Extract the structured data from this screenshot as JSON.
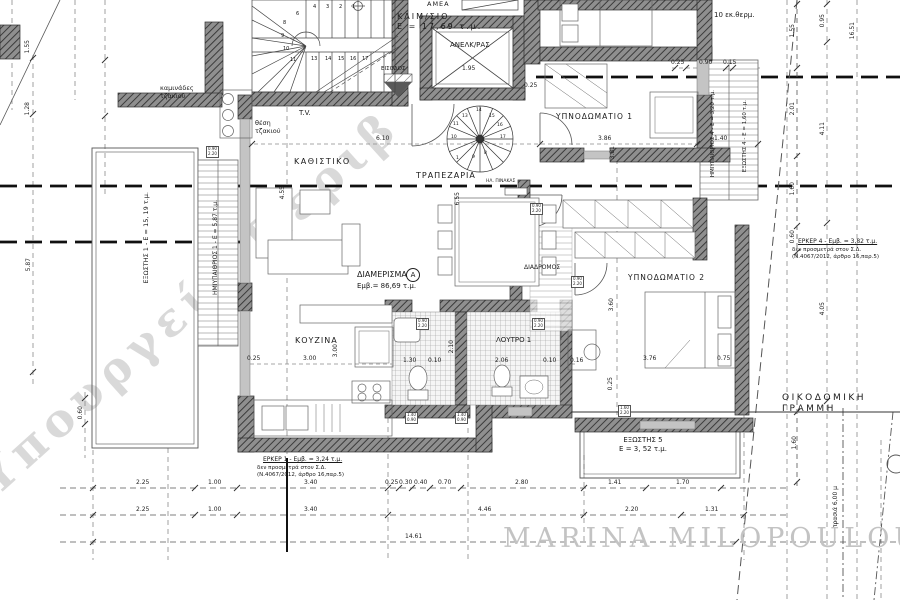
{
  "watermarks": {
    "diagonal": "Υπουργείο Περιβ",
    "signature": "MARINA MILOPOULOU"
  },
  "labels": {
    "living": "ΚΑΘΙΣΤΙΚΟ",
    "tv": "T.V.",
    "fireplace": "θέση\nτζακιού",
    "chimneys": "καμινάδες\nτζακιού",
    "staircase": "ΚΛΙΜ/ΣΙΟ\nΕ = 17,69 τ.μ.",
    "elevator": "ΑΝΕΛΚ/ΡΑΣ",
    "amea": "ΑΜΕΑ",
    "entrance": "ΕΙΣΟΔΟΣ",
    "dining": "ΤΡΑΠΕΖΑΡΙΑ",
    "bedroom1": "ΥΠΝΟΔΩΜΑΤΙΟ 1",
    "insulation": "10 εκ.θερμ.",
    "apartment": "ΔΙΑΜΕΡΙΣΜΑ",
    "apartment_badge": "A",
    "apartment_area": "Εμβ.= 86,69 τ.μ.",
    "kitchen": "ΚΟΥΖΙΝΑ",
    "bathroom": "ΛΟΥΤΡΟ 1",
    "corridor": "ΔΙΑΔΡΟΜΟΣ",
    "bedroom2": "ΥΠΝΟΔΩΜΑΤΙΟ 2",
    "balcony5": "ΕΞΩΣΤΗΣ 5\nΕ = 3, 52 τ.μ.",
    "building_line": "ΟΙΚΟΔΟΜΙΚΗ ΓΡΑΜΜΗ",
    "panel": "ΗΛ. ΠΙΝΑΚΑΣ",
    "balcony1": "ΕΞΩΣΤΗΣ 1 - Ε = 15, 19 τ.μ.",
    "semi1": "ΗΜΙΥΠΑΙΘΡΙΟΣ 1 - Ε = 5,87 τ.μ.",
    "semi4": "ΗΜΙΥΠΑΙΘΡΙΟΣ 4 - Ε = 3,20 τ.μ.",
    "balcony4": "ΕΞΩΣΤΗΣ 4 - Ε = 1,60 τ.μ.",
    "grass": "πρασιά 6,00 μ"
  },
  "notes": {
    "erker1_title": "ΕΡΚΕΡ 1 - Εμβ. = 3,24 τ.μ.",
    "erker1_body": "δεν προσμετρά στον Σ.Δ.\n(Ν.4067/2012, άρθρο 16,παρ.5)",
    "erker4_title": "ΕΡΚΕΡ 4 - Εμβ. = 3,82 τ.μ.",
    "erker4_body": "δεν προσμετρά στον Σ.Δ.\n(Ν.4067/2012, άρθρο 16,παρ.5)"
  },
  "dims": {
    "bottom1": [
      "2.25",
      "1.00",
      "3.40",
      "0.25",
      "0.30",
      "0.40",
      "0.70",
      "2.80",
      "1.41",
      "1.70"
    ],
    "bottom2": [
      "2.25",
      "1.00",
      "3.40",
      "4.46",
      "2.20",
      "1.31"
    ],
    "total": "14.61",
    "left": {
      "a": "1.55",
      "b": "1.28",
      "c": "5.87",
      "d": "0.60"
    },
    "right": {
      "a": "1.55",
      "b": "2.01",
      "c": "1.60",
      "d": "0.60",
      "e": "0.95",
      "f": "4.11",
      "g": "4.05",
      "h": "16.51",
      "i": "1.60"
    },
    "inner": {
      "elev": "1.95",
      "hall": "0.25",
      "living_w": "6.10",
      "bed1_w": "3.86",
      "bed1_h": "3.81",
      "t1": "0.25",
      "t2": "0.90",
      "t3": "0.15",
      "liv_h": "4.55",
      "din_h": "6.55",
      "k1": "0.25",
      "k2": "3.00",
      "k3": "3.00",
      "b1": "2.10",
      "b2": "1.30",
      "b3": "0.10",
      "b4": "2.06",
      "b5": "0.10",
      "b6": "0.16",
      "bed2_h": "3.60",
      "bed2_w": "3.76",
      "r1": "0.75",
      "r2": "0.25",
      "bal4": "1.40"
    }
  },
  "stairs": {
    "main": [
      "1",
      "2",
      "3",
      "4",
      "6",
      "8",
      "9",
      "10",
      "11",
      "13",
      "14",
      "15",
      "16",
      "17"
    ],
    "spiral": [
      "13",
      "14",
      "15",
      "16",
      "17",
      "11",
      "10",
      "1",
      "9",
      "8"
    ]
  },
  "tags": [
    "0.90\n2.20",
    "0.90\n2.20",
    "0.90\n2.20",
    "0.90\n2.20",
    "0.90\n2.20",
    "1.60\n2.20",
    "1.40\n0.90",
    "1.40\n0.90"
  ]
}
